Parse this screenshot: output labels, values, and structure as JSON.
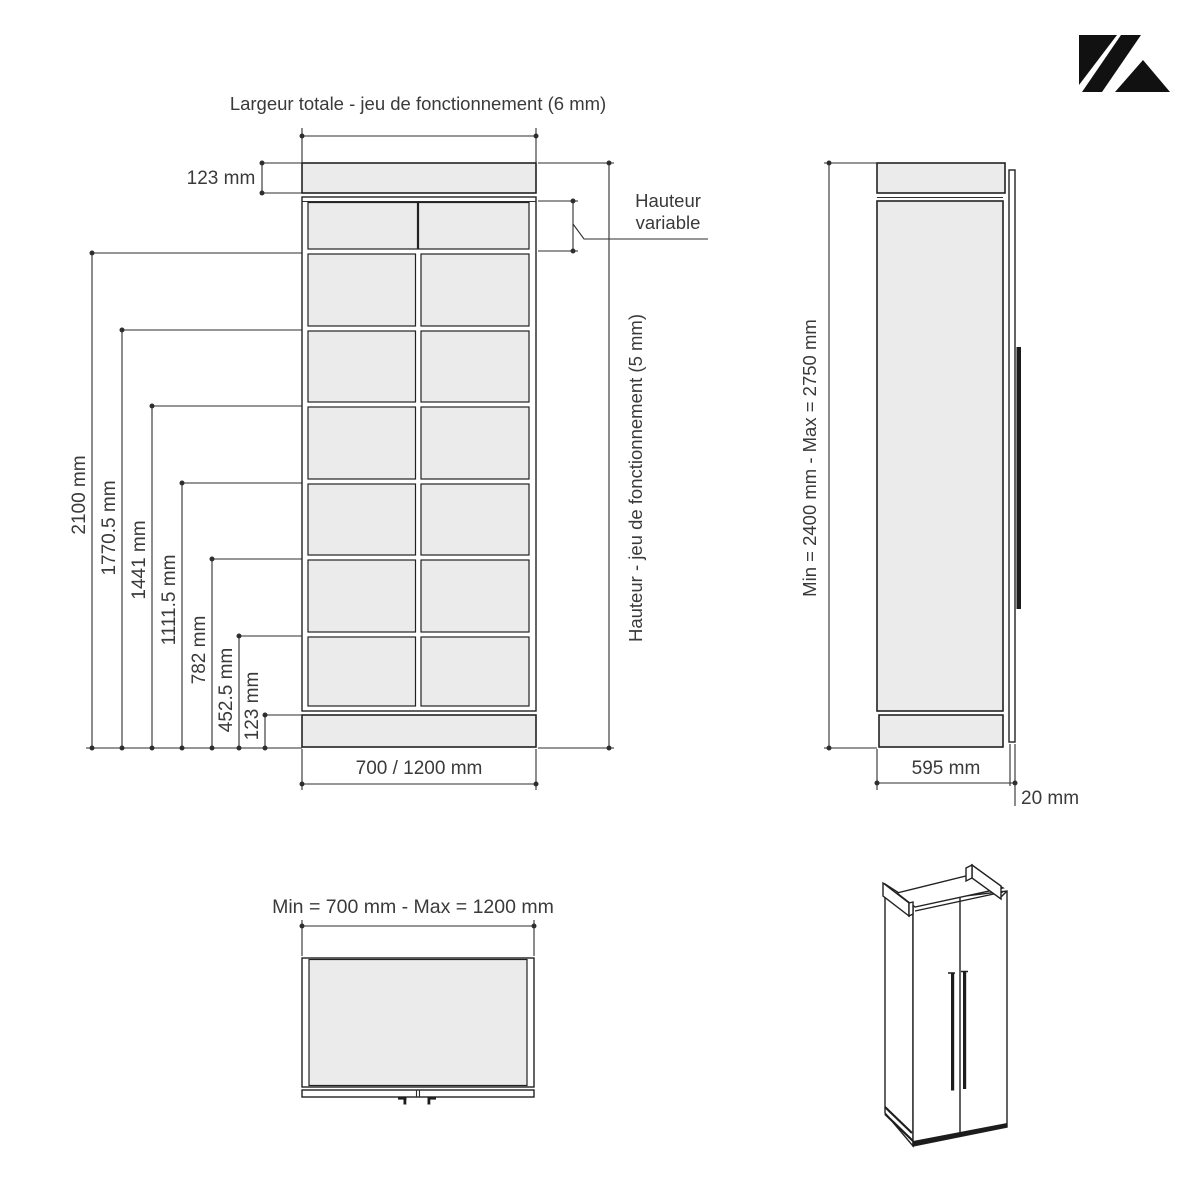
{
  "colors": {
    "panel_fill": "#ebebeb",
    "outline": "#222222",
    "dimension_line": "#2e2e2e",
    "text": "#3a3a3a",
    "logo": "#111111"
  },
  "front_view": {
    "title": "Largeur totale - jeu de fonctionnement (6 mm)",
    "top_cap_height_label": "123 mm",
    "variable_height_label": {
      "line1": "Hauteur",
      "line2": "variable"
    },
    "height_clearance_label": "Hauteur - jeu de fonctionnement (5 mm)",
    "width_label": "700 / 1200 mm",
    "height_labels": [
      "2100 mm",
      "1770.5 mm",
      "1441 mm",
      "1111.5 mm",
      "782 mm",
      "452.5 mm",
      "123 mm"
    ]
  },
  "side_view": {
    "height_range_label": "Min = 2400 mm - Max = 2750 mm",
    "depth_label": "595 mm",
    "door_thickness_label": "20 mm"
  },
  "top_view": {
    "width_range_label": "Min = 700 mm - Max = 1200 mm"
  }
}
